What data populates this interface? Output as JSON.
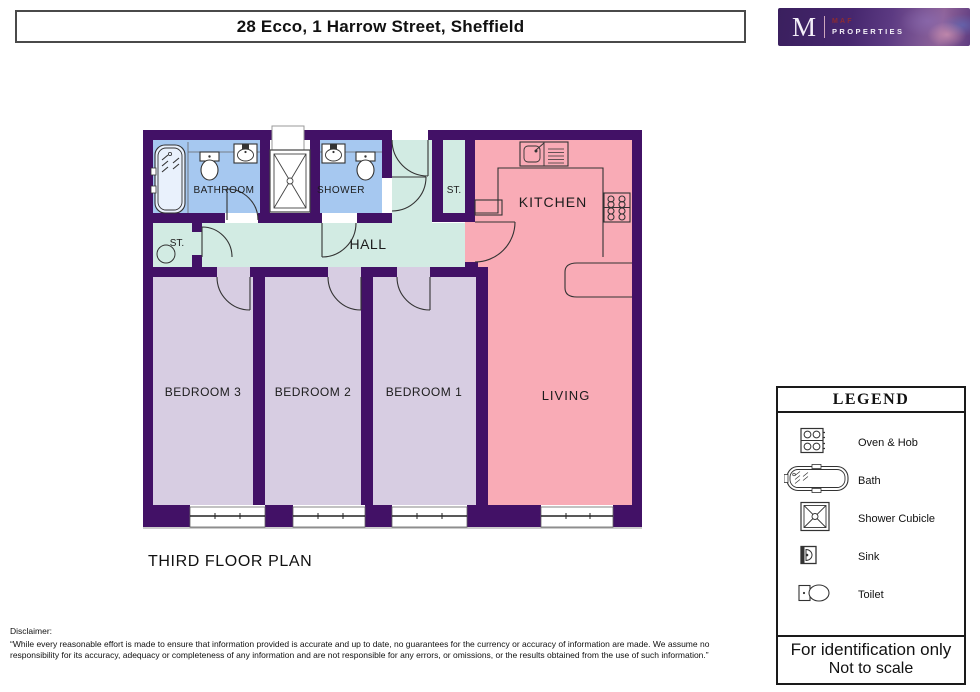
{
  "title_bar": {
    "text": "28 Ecco, 1 Harrow Street, Sheffield"
  },
  "logo": {
    "letter": "M",
    "line1": "MAF",
    "line2": "PROPERTIES"
  },
  "plan": {
    "caption": "THIRD FLOOR PLAN",
    "rooms": {
      "bathroom": "BATHROOM",
      "shower": "SHOWER",
      "st_top": "ST.",
      "st_left": "ST.",
      "hall": "HALL",
      "kitchen": "KITCHEN",
      "living": "LIVING",
      "bedroom1": "BEDROOM 1",
      "bedroom2": "BEDROOM 2",
      "bedroom3": "BEDROOM 3"
    }
  },
  "colors": {
    "wall": "#421166",
    "bathroom_blue": "#a6c8f0",
    "hall_green": "#d2ebe3",
    "bedroom_lavender": "#d7cde2",
    "kitchen_pink": "#f9abb6",
    "cubicle_white": "#ffffff"
  },
  "legend": {
    "title": "LEGEND",
    "items": [
      {
        "label": "Oven & Hob"
      },
      {
        "label": "Bath"
      },
      {
        "label": "Shower Cubicle"
      },
      {
        "label": "Sink"
      },
      {
        "label": "Toilet"
      }
    ],
    "footer_line1": "For identification only",
    "footer_line2": "Not to scale"
  },
  "disclaimer": {
    "heading": "Disclaimer:",
    "body": "“While every reasonable effort is made to ensure that information provided is accurate and up to date, no guarantees for the currency or accuracy of information are made. We assume no responsibility for its accuracy, adequacy or completeness of any information and are not responsible for any errors, or omissions, or the results obtained from the use of such information.”"
  }
}
